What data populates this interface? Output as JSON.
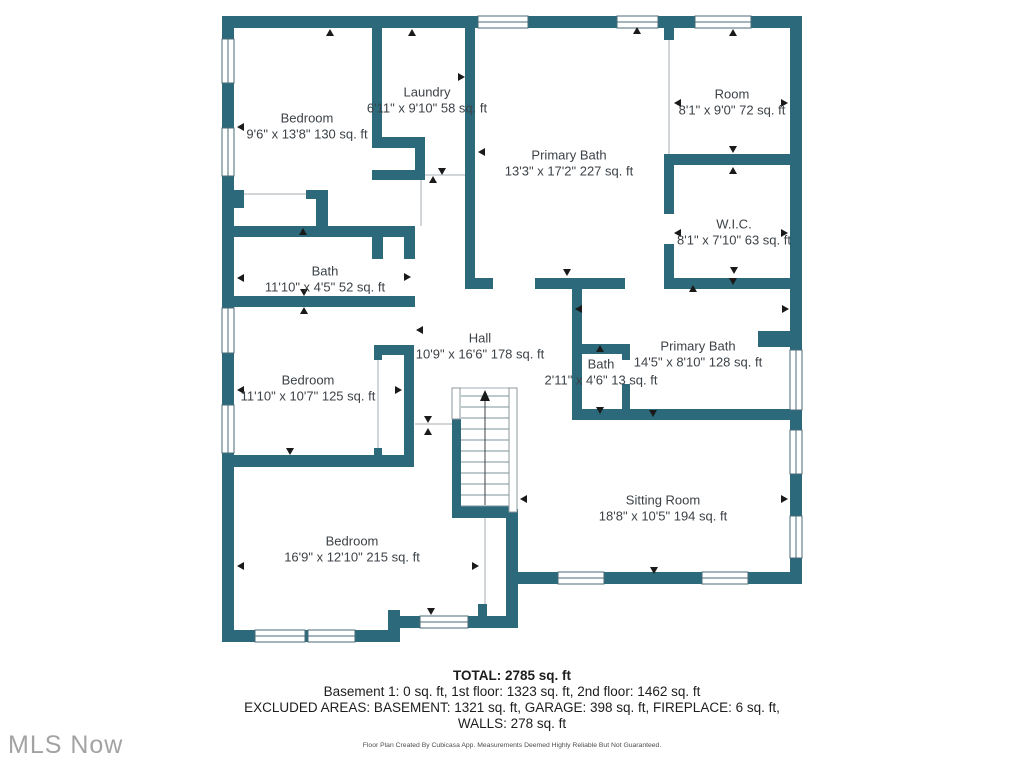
{
  "floorplan": {
    "wall_color": "#2b697b",
    "rooms": [
      {
        "name": "Bedroom",
        "dims": "9'6\" x 13'8\" 130 sq. ft"
      },
      {
        "name": "Laundry",
        "dims": "6'11\" x 9'10\" 58 sq. ft"
      },
      {
        "name": "Primary Bath",
        "dims": "13'3\" x 17'2\" 227 sq. ft"
      },
      {
        "name": "Room",
        "dims": "8'1\" x 9'0\" 72 sq. ft"
      },
      {
        "name": "W.I.C.",
        "dims": "8'1\" x 7'10\" 63 sq. ft"
      },
      {
        "name": "Bath",
        "dims": "11'10\" x 4'5\" 52 sq. ft"
      },
      {
        "name": "Hall",
        "dims": "10'9\" x 16'6\" 178 sq. ft"
      },
      {
        "name": "Bath",
        "dims": "2'11\" x 4'6\" 13 sq. ft"
      },
      {
        "name": "Primary Bath",
        "dims": "14'5\" x 8'10\" 128 sq. ft"
      },
      {
        "name": "Bedroom",
        "dims": "11'10\" x 10'7\" 125 sq. ft"
      },
      {
        "name": "Sitting Room",
        "dims": "18'8\" x 10'5\" 194 sq. ft"
      },
      {
        "name": "Bedroom",
        "dims": "16'9\" x 12'10\" 215 sq. ft"
      }
    ]
  },
  "summary": {
    "total": "TOTAL: 2785 sq. ft",
    "floors": "Basement 1: 0 sq. ft, 1st floor: 1323 sq. ft, 2nd floor: 1462 sq. ft",
    "excluded": "EXCLUDED AREAS: BASEMENT: 1321 sq. ft, GARAGE: 398 sq. ft, FIREPLACE: 6 sq. ft,",
    "walls": "WALLS: 278 sq. ft",
    "disclaimer": "Floor Plan Created By Cubicasa App. Measurements Deemed Highly Reliable But Not Guaranteed."
  },
  "watermark": "MLS Now"
}
